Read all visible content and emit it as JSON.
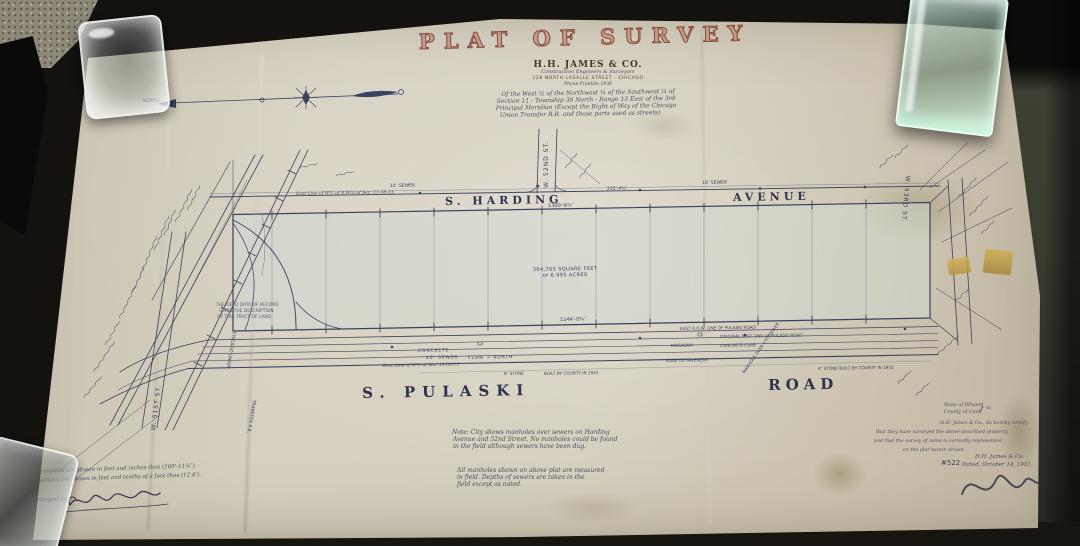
{
  "colors": {
    "paper": "#d4cdbb",
    "ink": "#3b4160",
    "title_red": "#8a4b3c",
    "parcel_fill": "#cfdad2",
    "desk_green": "#3c4134"
  },
  "objects": {
    "top_left_weight": "glass paperweight",
    "top_right_weight": "green glass paperweight",
    "bottom_left_weight": "glass paperweight",
    "tape_bits": "yellowed tape"
  },
  "north_arrow": {
    "label": "NORTH"
  },
  "title_block": {
    "title": "PLAT OF SURVEY",
    "firm": "H.H. JAMES & CO.",
    "firm_subtitle": "Construction Engineers & Surveyors",
    "address": "228 NORTH LASALLE STREET · CHICAGO",
    "phone": "Phone Franklin 1936",
    "description_lines": [
      "Of the West ½ of the Northwest ¼ of the Southwest ¼ of",
      "Section 11 - Township 38 North - Range 13 East of the 3rd",
      "Principal Meridian (Except the Right of Way of the Chicago",
      "Union Transfer R.R. and those parts used as streets)"
    ]
  },
  "plat": {
    "streets": {
      "top_left": "S. HARDING",
      "top_right": "AVENUE",
      "bottom_left": "S. PULASKI",
      "bottom_right": "ROAD",
      "cross_street": "W. 52ND ST.",
      "left_street": "W. 51ST ST.",
      "right_street": "W. 53RD ST.",
      "railroad_1": "CHICAGO UNION",
      "railroad_2": "TRANSFER R.R."
    },
    "area": {
      "line1": "304,705 SQUARE FEET",
      "line2": "or 6.995 ACRES"
    },
    "dimensions": {
      "top": "1300'-6½″",
      "corner": "235'-4¾″",
      "bottom": "1144'-0¾″"
    },
    "annotations": {
      "sewer_top_1": "10″ SEWER",
      "sewer_top_2": "10″ SEWER",
      "east_line": "East Line of W½ of S.W.¼ of Sec. 11-38-13",
      "west_line": "West Line of W½ of Sec. 11-38-13",
      "concrete": "CONCRETE",
      "sewer_40": "40″ SEWER",
      "flow": "FLOW → NORTH",
      "stone_8": "8″ STONE",
      "county": "BUILT BY COUNTY IN 1931",
      "stone_4": "4″ STONE BUILT BY COUNTY IN 1931",
      "row_line": "EAST R.O.W. LINE OF PULASKI ROAD",
      "orig_line": "ORIGINAL EAST LINE OF PULASKI ROAD",
      "macadam": "MACADAM",
      "curb": "CONCRETE CURB",
      "pavement": "EDGE OF PAVEMENT",
      "manhole": "MANHOLE OVER CITY SEWER",
      "deed_1": "THE DEED DATA OF RECORD",
      "deed_2": "GIVES THE DESCRIPTION",
      "deed_3": "OF THIS TRACT OF LAND"
    }
  },
  "notes": {
    "note1": [
      "Note: City shows manholes over sewers on Harding",
      "Avenue and 52nd Street. No manholes could be found",
      "in the field although sewers have been dug."
    ],
    "note2": [
      "All manholes shown on above plat are measured",
      "in field. Depths of sewers are taken in the",
      "field except as noted."
    ]
  },
  "legend": {
    "line1": "Dimensions are shown in feet and inches thus (109'-11¼″).",
    "line2": "Elevations are shown in feet and tenths of a foot thus (12.4').",
    "surveyed_by": "Surveyed by:"
  },
  "certification": {
    "state": "State of Illinois",
    "brace": "}",
    "ss": "ss",
    "county": "County of Cook",
    "body": [
      "H.H. James & Co., do hereby certify",
      "that they have surveyed the above described property",
      "and that the survey of same is correctly represented",
      "on the plat herein drawn."
    ],
    "firm": "H.H. James & Co.",
    "dated": "Dated, October 14, 1931.",
    "job_number": "#522"
  }
}
